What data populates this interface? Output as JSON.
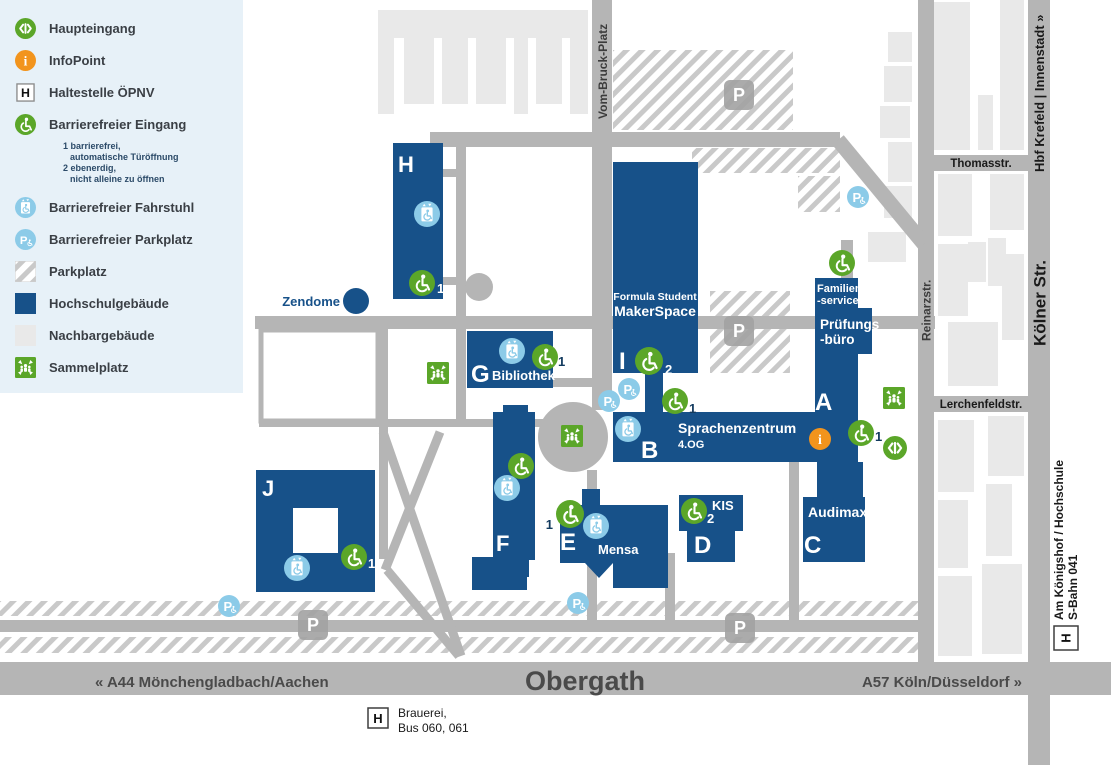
{
  "colors": {
    "blue": "#175189",
    "green": "#5ba629",
    "lightblue": "#8ccbe8",
    "orange": "#f2941d",
    "road": "#b5b5b5",
    "neighbor": "#e9e9e9",
    "hatch": "#c9c9c9",
    "legend_bg": "#e7f1f8",
    "navy_text": "#123a5e",
    "street_text": "#3c3c3c"
  },
  "legend": {
    "items": [
      {
        "label": "Haupteingang"
      },
      {
        "label": "InfoPoint"
      },
      {
        "label": "Haltestelle ÖPNV"
      },
      {
        "label": "Barrierefreier Eingang"
      },
      {
        "label": "Barrierefreier Fahrstuhl"
      },
      {
        "label": "Barrierefreier Parkplatz"
      },
      {
        "label": "Parkplatz"
      },
      {
        "label": "Hochschulgebäude"
      },
      {
        "label": "Nachbargebäude"
      },
      {
        "label": "Sammelplatz"
      }
    ],
    "entrance_notes": [
      "1 barrierefrei,",
      "automatische Türöffnung",
      "2 ebenerdig,",
      "nicht alleine zu öffnen"
    ]
  },
  "icons": {
    "info_glyph": "i",
    "p_glyph": "P",
    "h_glyph": "H"
  },
  "map": {
    "buildings": {
      "h": "H",
      "g": "G",
      "i": "I",
      "b": "B",
      "a": "A",
      "c": "C",
      "d": "D",
      "e": "E",
      "f": "F",
      "j": "J"
    },
    "labels": {
      "bibliothek": "Bibliothek",
      "formula_student": "Formula Student",
      "makerspace": "MakerSpace",
      "sprachenzentrum": "Sprachenzentrum",
      "og": "4.OG",
      "familien_line1": "Familien",
      "familien_line2": "-service",
      "pruefungs_line1": "Prüfungs",
      "pruefungs_line2": "-büro",
      "audimax": "Audimax",
      "kis": "KIS",
      "mensa": "Mensa",
      "zendome": "Zendome"
    },
    "streets": {
      "vom_bruck_platz": "Vom-Bruck-Platz",
      "thomasstr": "Thomasstr.",
      "reinarzstr": "Reinarzstr.",
      "lerchenfeldstr": "Lerchenfeldstr.",
      "koelner_str": "Kölner Str.",
      "hbf": "Hbf Krefeld | Innenstadt »",
      "obergath": "Obergath",
      "a44": "« A44 Mönchengladbach/Aachen",
      "a57": "A57 Köln/Düsseldorf »",
      "koenigshof": "Am Königshof / Hochschule",
      "sbahn": "S-Bahn 041"
    },
    "stops": {
      "brauerei_line1": "Brauerei,",
      "brauerei_line2": "Bus 060, 061"
    },
    "badges": {
      "h": "1",
      "g": "1",
      "i": "2",
      "i_lower": "1",
      "a": "1",
      "d": "2",
      "e": "1",
      "j": "1"
    }
  }
}
